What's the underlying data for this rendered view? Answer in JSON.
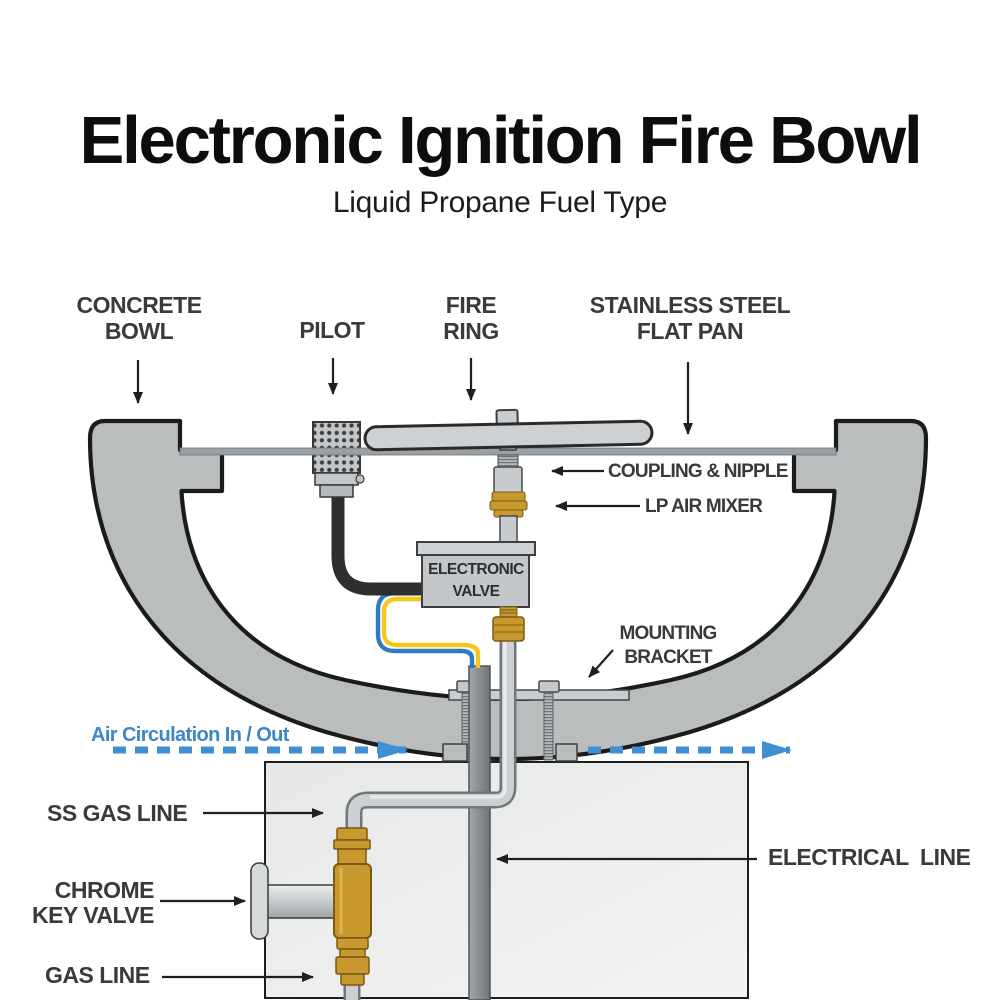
{
  "title": "Electronic Ignition Fire Bowl",
  "subtitle": "Liquid Propane Fuel Type",
  "callouts": {
    "concrete_bowl": "CONCRETE\nBOWL",
    "pilot": "PILOT",
    "fire_ring": "FIRE\nRING",
    "flat_pan": "STAINLESS STEEL\nFLAT PAN",
    "coupling_nipple": "COUPLING & NIPPLE",
    "lp_air_mixer": "LP AIR MIXER",
    "electronic_valve": "ELECTRONIC\nVALVE",
    "mounting_bracket": "MOUNTING\nBRACKET",
    "air_circulation": "Air Circulation In / Out",
    "ss_gas_line": "SS GAS LINE",
    "chrome_key_valve": "CHROME\nKEY VALVE",
    "gas_line": "GAS LINE",
    "electrical_line": "ELECTRICAL  LINE"
  },
  "colors": {
    "label_text": "#3a3a3a",
    "title_text": "#0d0d0d",
    "air_circulation_blue": "#3c87c8",
    "dashed_arrow_blue": "#3f8fd2",
    "bowl_gray": "#b9bdbe",
    "pedestal_gray": "#eceeee",
    "brass_gold": "#c8992e",
    "wire_blue": "#2e7cc0",
    "wire_yellow": "#f2c81a",
    "outline_black": "#1c1c1c"
  }
}
